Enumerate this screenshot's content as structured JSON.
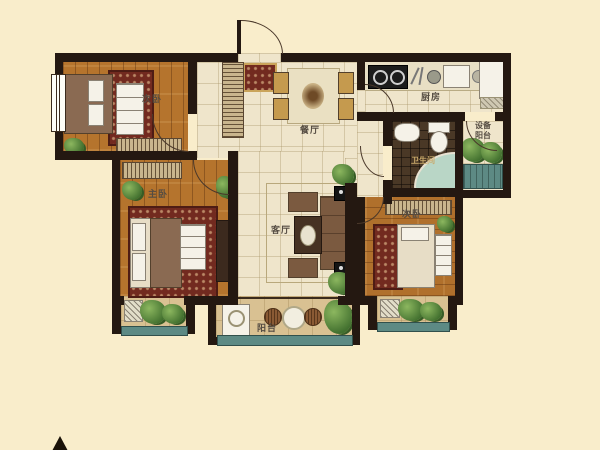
{
  "rooms": {
    "bedroom_top_left": {
      "label": "次卧"
    },
    "dining": {
      "label": "餐厅"
    },
    "kitchen": {
      "label": "厨房"
    },
    "utility_balcony": {
      "label_line1": "设备",
      "label_line2": "阳台"
    },
    "bathroom": {
      "label": "卫生间"
    },
    "master_bedroom": {
      "label": "主卧"
    },
    "living_room": {
      "label": "客厅"
    },
    "bedroom_right": {
      "label": "次卧"
    },
    "balcony": {
      "label": "阳台"
    }
  },
  "colors": {
    "background": "#f9edcb",
    "wall": "#241811",
    "wood_floor": "#b5742d",
    "tile_floor": "#efe5cb",
    "bathroom_tile": "#4a3826",
    "balcony_floor": "#d9c192",
    "window_teal": "#5d8a84",
    "plant_green": "#4e7c37",
    "rug_red": "#722a1f"
  }
}
